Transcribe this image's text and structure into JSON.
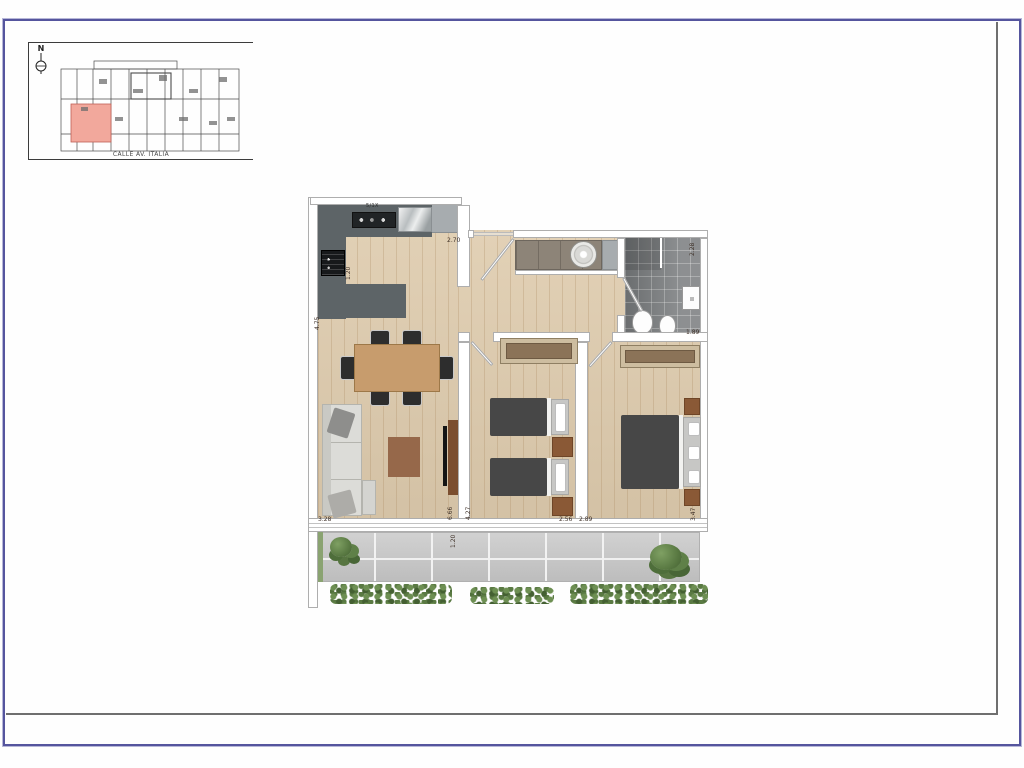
{
  "keyplan": {
    "north_label": "N",
    "street_label": "CALLE AV. ITALIA"
  },
  "floorplan": {
    "cooktop_label": "5/1X",
    "dimension_labels": [
      {
        "text": "2.70",
        "x": 139,
        "y": 43,
        "rot": false
      },
      {
        "text": "1.20",
        "x": 38,
        "y": 85,
        "rot": true
      },
      {
        "text": "4.75",
        "x": 7,
        "y": 135,
        "rot": true
      },
      {
        "text": "3.28",
        "x": 10,
        "y": 322,
        "rot": false
      },
      {
        "text": "6.66",
        "x": 140,
        "y": 325,
        "rot": true
      },
      {
        "text": "4.27",
        "x": 158,
        "y": 325,
        "rot": true
      },
      {
        "text": "1.20",
        "x": 143,
        "y": 353,
        "rot": true
      },
      {
        "text": "2.56",
        "x": 251,
        "y": 322,
        "rot": false
      },
      {
        "text": "2.89",
        "x": 271,
        "y": 322,
        "rot": false
      },
      {
        "text": "3.47",
        "x": 383,
        "y": 326,
        "rot": true
      },
      {
        "text": "2.28",
        "x": 382,
        "y": 61,
        "rot": true
      },
      {
        "text": "1.89",
        "x": 378,
        "y": 135,
        "rot": false
      }
    ]
  }
}
